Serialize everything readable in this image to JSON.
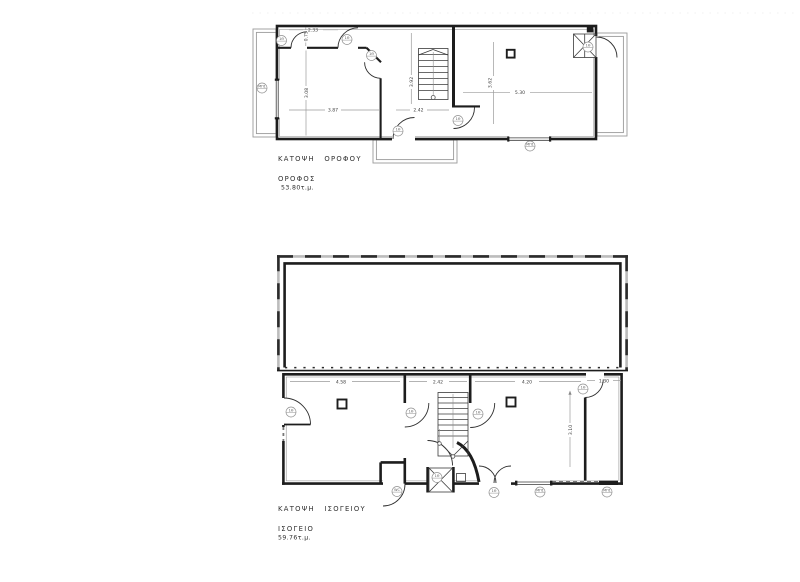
{
  "document": {
    "background_color": "#ffffff",
    "type_note": "architectural floor plan drawing, two storeys"
  },
  "upper_plan": {
    "title": "ΚΑΤΟΨΗ ΟΡΟΦΟΥ",
    "floor_label": "ΟΡΟΦΟΣ",
    "area_label": "53.80τ.μ.",
    "dimensions": {
      "entry_width": "2.33",
      "corridor_depth": "0.75",
      "left_room_height": "3.08",
      "left_room_width": "3.87",
      "stair_hall_height": "3.92",
      "stair_hall_width": "2.42",
      "right_room_height": "3.62",
      "right_room_width": "5.30"
    },
    "tags": [
      "1Θ",
      "1Θ",
      "1Θ",
      "1Θ",
      "1Θ",
      "1Θ",
      "ΜΠ1",
      "ΜΠ1"
    ]
  },
  "ground_plan": {
    "title": "ΚΑΤΟΨΗ ΙΣΟΓΕΙΟΥ",
    "floor_label": "ΙΣΟΓΕΙΟ",
    "area_label": "59.76τ.μ.",
    "dimensions": {
      "left_room_width": "4.58",
      "stair_hall_width": "2.42",
      "right_room_width": "4.20",
      "entry_niche_width": "1.30",
      "right_room_height": "3.10"
    },
    "tags": [
      "1Θ",
      "1Θ",
      "1Θ",
      "1Θ",
      "1Θ",
      "WC",
      "1Θ",
      "ΜΠ1",
      "ΜΠ1"
    ]
  },
  "colors": {
    "wall": "#1d1d1d",
    "dimension_text": "#3f3f3f",
    "light_outline": "#9a9a9a",
    "background": "#ffffff"
  }
}
